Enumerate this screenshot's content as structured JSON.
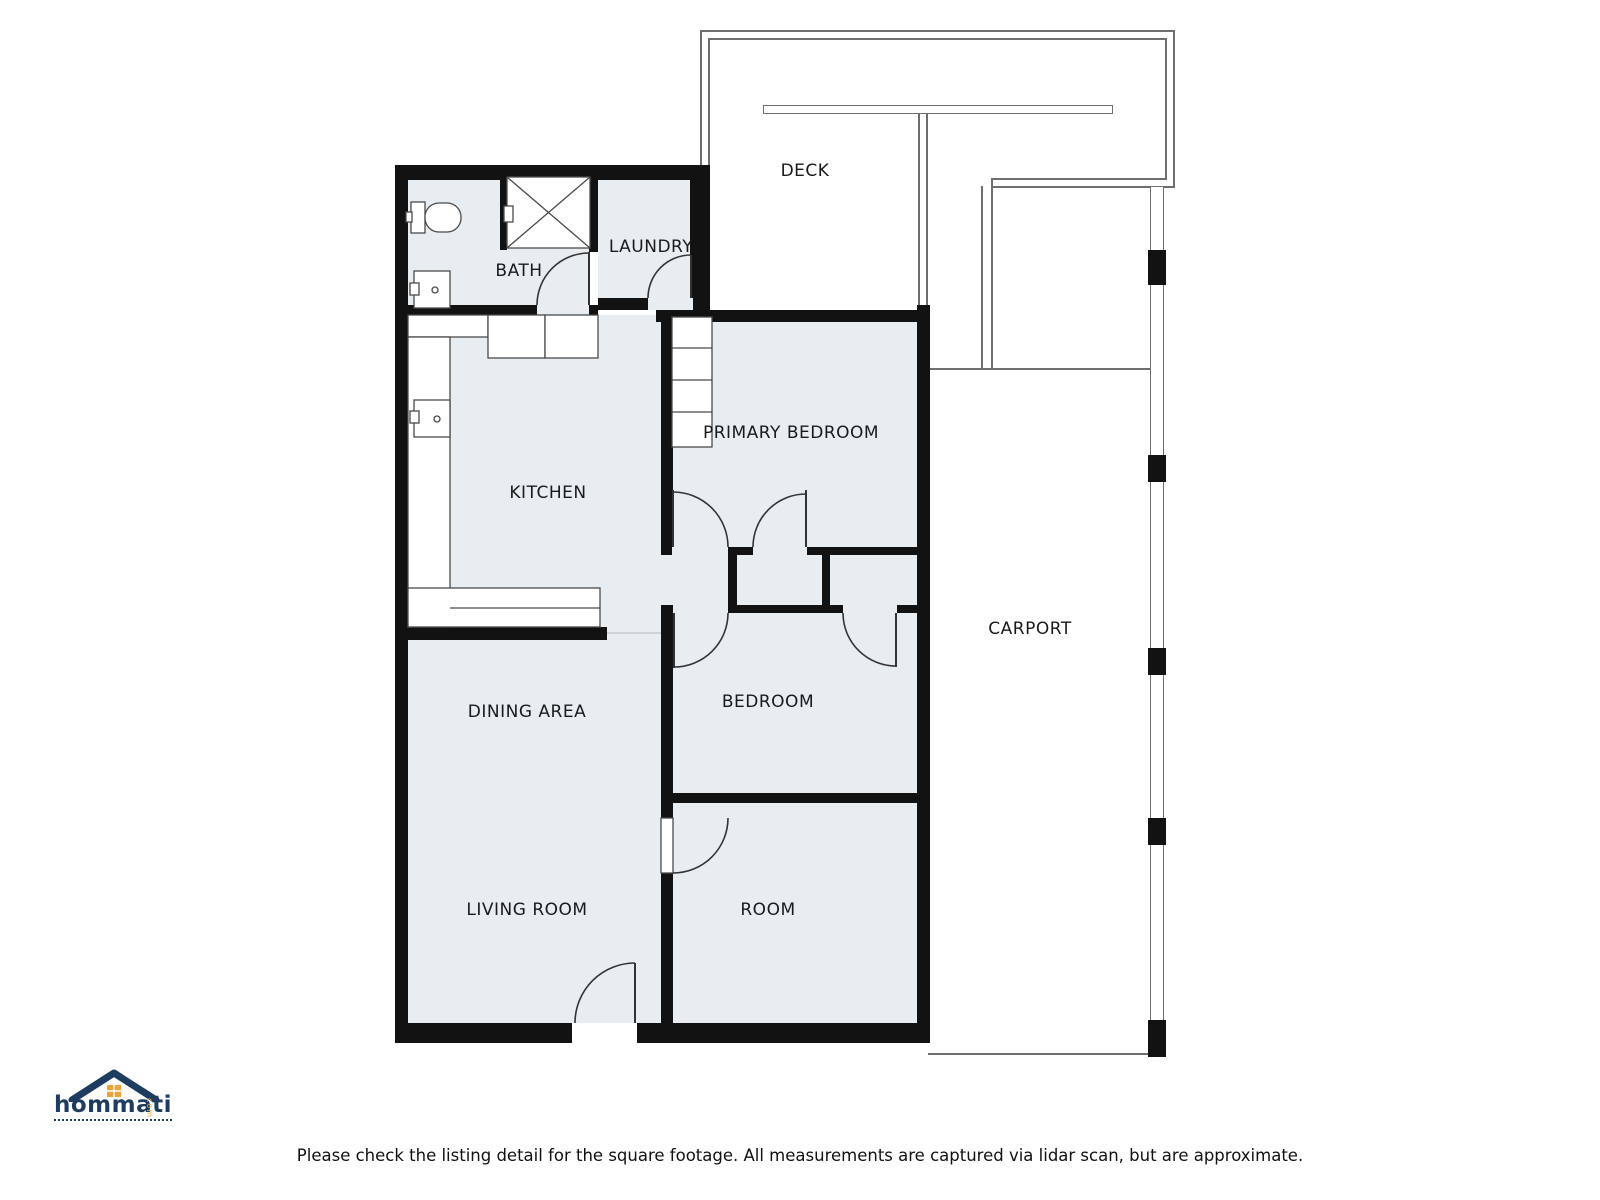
{
  "canvas": {
    "width": 1600,
    "height": 1200,
    "background": "#ffffff"
  },
  "colors": {
    "wall": "#121212",
    "room_fill": "#e8edf2",
    "outline": "#6e6e6e",
    "door": "#333333",
    "fixture": "#4a4a4a",
    "label": "#1a1a1a",
    "logo_navy": "#1e3c5f",
    "logo_orange": "#f0a339"
  },
  "rooms": [
    {
      "id": "deck",
      "label": "DECK",
      "cx": 805,
      "cy": 171
    },
    {
      "id": "bath",
      "label": "BATH",
      "cx": 519,
      "cy": 271
    },
    {
      "id": "laundry",
      "label": "LAUNDRY",
      "cx": 651,
      "cy": 247
    },
    {
      "id": "kitchen",
      "label": "KITCHEN",
      "cx": 548,
      "cy": 493
    },
    {
      "id": "primary-bedroom",
      "label": "PRIMARY BEDROOM",
      "cx": 791,
      "cy": 433
    },
    {
      "id": "dining-area",
      "label": "DINING AREA",
      "cx": 527,
      "cy": 712
    },
    {
      "id": "bedroom",
      "label": "BEDROOM",
      "cx": 768,
      "cy": 702
    },
    {
      "id": "carport",
      "label": "CARPORT",
      "cx": 1030,
      "cy": 629
    },
    {
      "id": "living-room",
      "label": "LIVING ROOM",
      "cx": 527,
      "cy": 910
    },
    {
      "id": "room",
      "label": "ROOM",
      "cx": 768,
      "cy": 910
    }
  ],
  "footer": {
    "disclaimer": "Please check the listing detail for the square footage. All measurements are captured via lidar scan, but are approximate."
  },
  "logo": {
    "brand": "hommati",
    "suffix": "com"
  },
  "floorplan": {
    "room_fills": [
      [
        408,
        180,
        181,
        125
      ],
      [
        598,
        180,
        92,
        118
      ],
      [
        408,
        315,
        253,
        312
      ],
      [
        661,
        552,
        67,
        53
      ],
      [
        737,
        555,
        85,
        50
      ],
      [
        830,
        555,
        87,
        50
      ],
      [
        673,
        322,
        244,
        225
      ],
      [
        673,
        613,
        244,
        180
      ],
      [
        673,
        803,
        244,
        220
      ],
      [
        408,
        640,
        253,
        383
      ],
      [
        607,
        627,
        54,
        13
      ]
    ],
    "walls": [
      [
        395,
        165,
        315,
        15
      ],
      [
        395,
        165,
        13,
        878
      ],
      [
        395,
        1023,
        535,
        20
      ],
      [
        917,
        305,
        13,
        738
      ],
      [
        690,
        165,
        20,
        145
      ],
      [
        589,
        165,
        9,
        87
      ],
      [
        500,
        177,
        7,
        73
      ],
      [
        395,
        305,
        142,
        10
      ],
      [
        589,
        305,
        9,
        10
      ],
      [
        598,
        298,
        50,
        12
      ],
      [
        693,
        298,
        17,
        24
      ],
      [
        656,
        310,
        274,
        12
      ],
      [
        395,
        627,
        212,
        13
      ],
      [
        661,
        310,
        12,
        242
      ],
      [
        661,
        605,
        12,
        213
      ],
      [
        661,
        873,
        12,
        150
      ],
      [
        661,
        547,
        269,
        8
      ],
      [
        661,
        605,
        269,
        8
      ],
      [
        728,
        547,
        9,
        66
      ],
      [
        822,
        547,
        8,
        66
      ],
      [
        661,
        793,
        269,
        10
      ]
    ],
    "door_openings": [
      [
        537,
        305,
        52,
        10
      ],
      [
        648,
        298,
        45,
        12
      ],
      [
        672,
        547,
        56,
        8
      ],
      [
        753,
        547,
        54,
        8
      ],
      [
        673,
        605,
        55,
        8
      ],
      [
        843,
        605,
        54,
        8
      ]
    ],
    "white_openings": [
      [
        572,
        1023,
        65,
        20
      ]
    ],
    "thresholds": [
      [
        607,
        632,
        54,
        2
      ]
    ],
    "deck_lines": [
      [
        700,
        30,
        475,
        2
      ],
      [
        708,
        38,
        459,
        2
      ],
      [
        700,
        30,
        2,
        135
      ],
      [
        708,
        38,
        2,
        127
      ],
      [
        1173,
        30,
        2,
        158
      ],
      [
        1165,
        38,
        2,
        142
      ],
      [
        993,
        186,
        182,
        2
      ],
      [
        993,
        178,
        172,
        2
      ],
      [
        981,
        186,
        2,
        184
      ],
      [
        991,
        178,
        2,
        192
      ],
      [
        928,
        368,
        230,
        2
      ],
      [
        918,
        107,
        2,
        198
      ],
      [
        926,
        107,
        2,
        198
      ],
      [
        928,
        1053,
        236,
        2
      ]
    ],
    "white_boxes": [
      [
        763,
        105,
        350,
        9
      ],
      [
        1150,
        186,
        14,
        871
      ]
    ],
    "posts": [
      [
        1148,
        250,
        18,
        35
      ],
      [
        1148,
        455,
        18,
        27
      ],
      [
        1148,
        648,
        18,
        27
      ],
      [
        1148,
        818,
        18,
        27
      ],
      [
        1148,
        1020,
        18,
        37
      ]
    ],
    "windows": [
      {
        "r": [
          393,
          183,
          16,
          94
        ],
        "m": [
          [
            393,
            230,
            409,
            230
          ]
        ]
      },
      {
        "r": [
          393,
          365,
          16,
          67
        ],
        "m": [
          [
            393,
            398,
            409,
            398
          ]
        ]
      },
      {
        "r": [
          393,
          434,
          16,
          70
        ],
        "m": [
          [
            393,
            469,
            409,
            469
          ]
        ]
      },
      {
        "r": [
          393,
          690,
          16,
          77
        ],
        "m": [
          [
            393,
            728,
            409,
            728
          ]
        ]
      },
      {
        "r": [
          393,
          773,
          16,
          75
        ],
        "m": [
          [
            393,
            810,
            409,
            810
          ]
        ]
      },
      {
        "r": [
          393,
          880,
          16,
          77
        ],
        "m": [
          [
            393,
            918,
            409,
            918
          ]
        ]
      },
      {
        "r": [
          915,
          390,
          16,
          80
        ],
        "m": [
          [
            915,
            430,
            931,
            430
          ]
        ]
      },
      {
        "r": [
          915,
          717,
          16,
          61
        ],
        "m": [
          [
            915,
            747,
            931,
            747
          ]
        ]
      },
      {
        "r": [
          915,
          883,
          16,
          74
        ],
        "m": [
          [
            915,
            920,
            931,
            920
          ]
        ]
      },
      {
        "r": [
          418,
          1021,
          71,
          17
        ],
        "m": [
          [
            453,
            1021,
            453,
            1038
          ]
        ]
      },
      {
        "r": [
          494,
          1021,
          72,
          17
        ],
        "m": [
          [
            530,
            1021,
            530,
            1038
          ]
        ]
      },
      {
        "r": [
          730,
          1021,
          77,
          17
        ],
        "m": [
          [
            768,
            1021,
            768,
            1038
          ]
        ]
      },
      {
        "r": [
          743,
          307,
          85,
          15
        ],
        "m": [
          [
            771,
            307,
            771,
            322
          ],
          [
            799,
            307,
            799,
            322
          ]
        ]
      }
    ],
    "svg": {
      "white_rects": [
        [
          507,
          177,
          83,
          71
        ],
        [
          672,
          317,
          40,
          130
        ],
        [
          408,
          315,
          80,
          22
        ],
        [
          488,
          315,
          57,
          43
        ],
        [
          545,
          315,
          53,
          43
        ],
        [
          408,
          337,
          42,
          290
        ],
        [
          408,
          588,
          192,
          39
        ],
        [
          661,
          818,
          12,
          55
        ],
        [
          411,
          202,
          14,
          31
        ],
        [
          414,
          271,
          36,
          37
        ],
        [
          414,
          400,
          36,
          37
        ],
        [
          410,
          283,
          9,
          12
        ],
        [
          410,
          411,
          9,
          12
        ],
        [
          504,
          206,
          9,
          16
        ],
        [
          406,
          212,
          6,
          10
        ]
      ],
      "round_rects": [
        [
          425,
          203,
          36,
          29,
          14
        ]
      ],
      "lines": [
        [
          507,
          177,
          590,
          248
        ],
        [
          590,
          177,
          507,
          248
        ],
        [
          672,
          348,
          712,
          348
        ],
        [
          672,
          380,
          712,
          380
        ],
        [
          672,
          412,
          712,
          412
        ],
        [
          450,
          608,
          600,
          608
        ]
      ],
      "leaves": [
        [
          589,
          252,
          589,
          305
        ],
        [
          691,
          255,
          691,
          298
        ],
        [
          673,
          490,
          673,
          547
        ],
        [
          806,
          490,
          806,
          547
        ],
        [
          674,
          613,
          674,
          668
        ],
        [
          896,
          613,
          896,
          667
        ],
        [
          635,
          963,
          635,
          1023
        ]
      ],
      "arcs": [
        "M537,305 A52,52 0 0 1 589,253",
        "M648,298 A43,43 0 0 1 691,255",
        "M728,547 A55,55 0 0 0 673,492",
        "M753,547 A53,53 0 0 1 806,494",
        "M728,613 A54,54 0 0 1 674,667",
        "M843,613 A53,53 0 0 0 896,666",
        "M728,818 A55,55 0 0 1 673,873",
        "M575,1023 A60,60 0 0 1 635,963"
      ],
      "circles": [
        [
          435,
          290,
          3
        ],
        [
          437,
          419,
          3
        ]
      ]
    }
  }
}
